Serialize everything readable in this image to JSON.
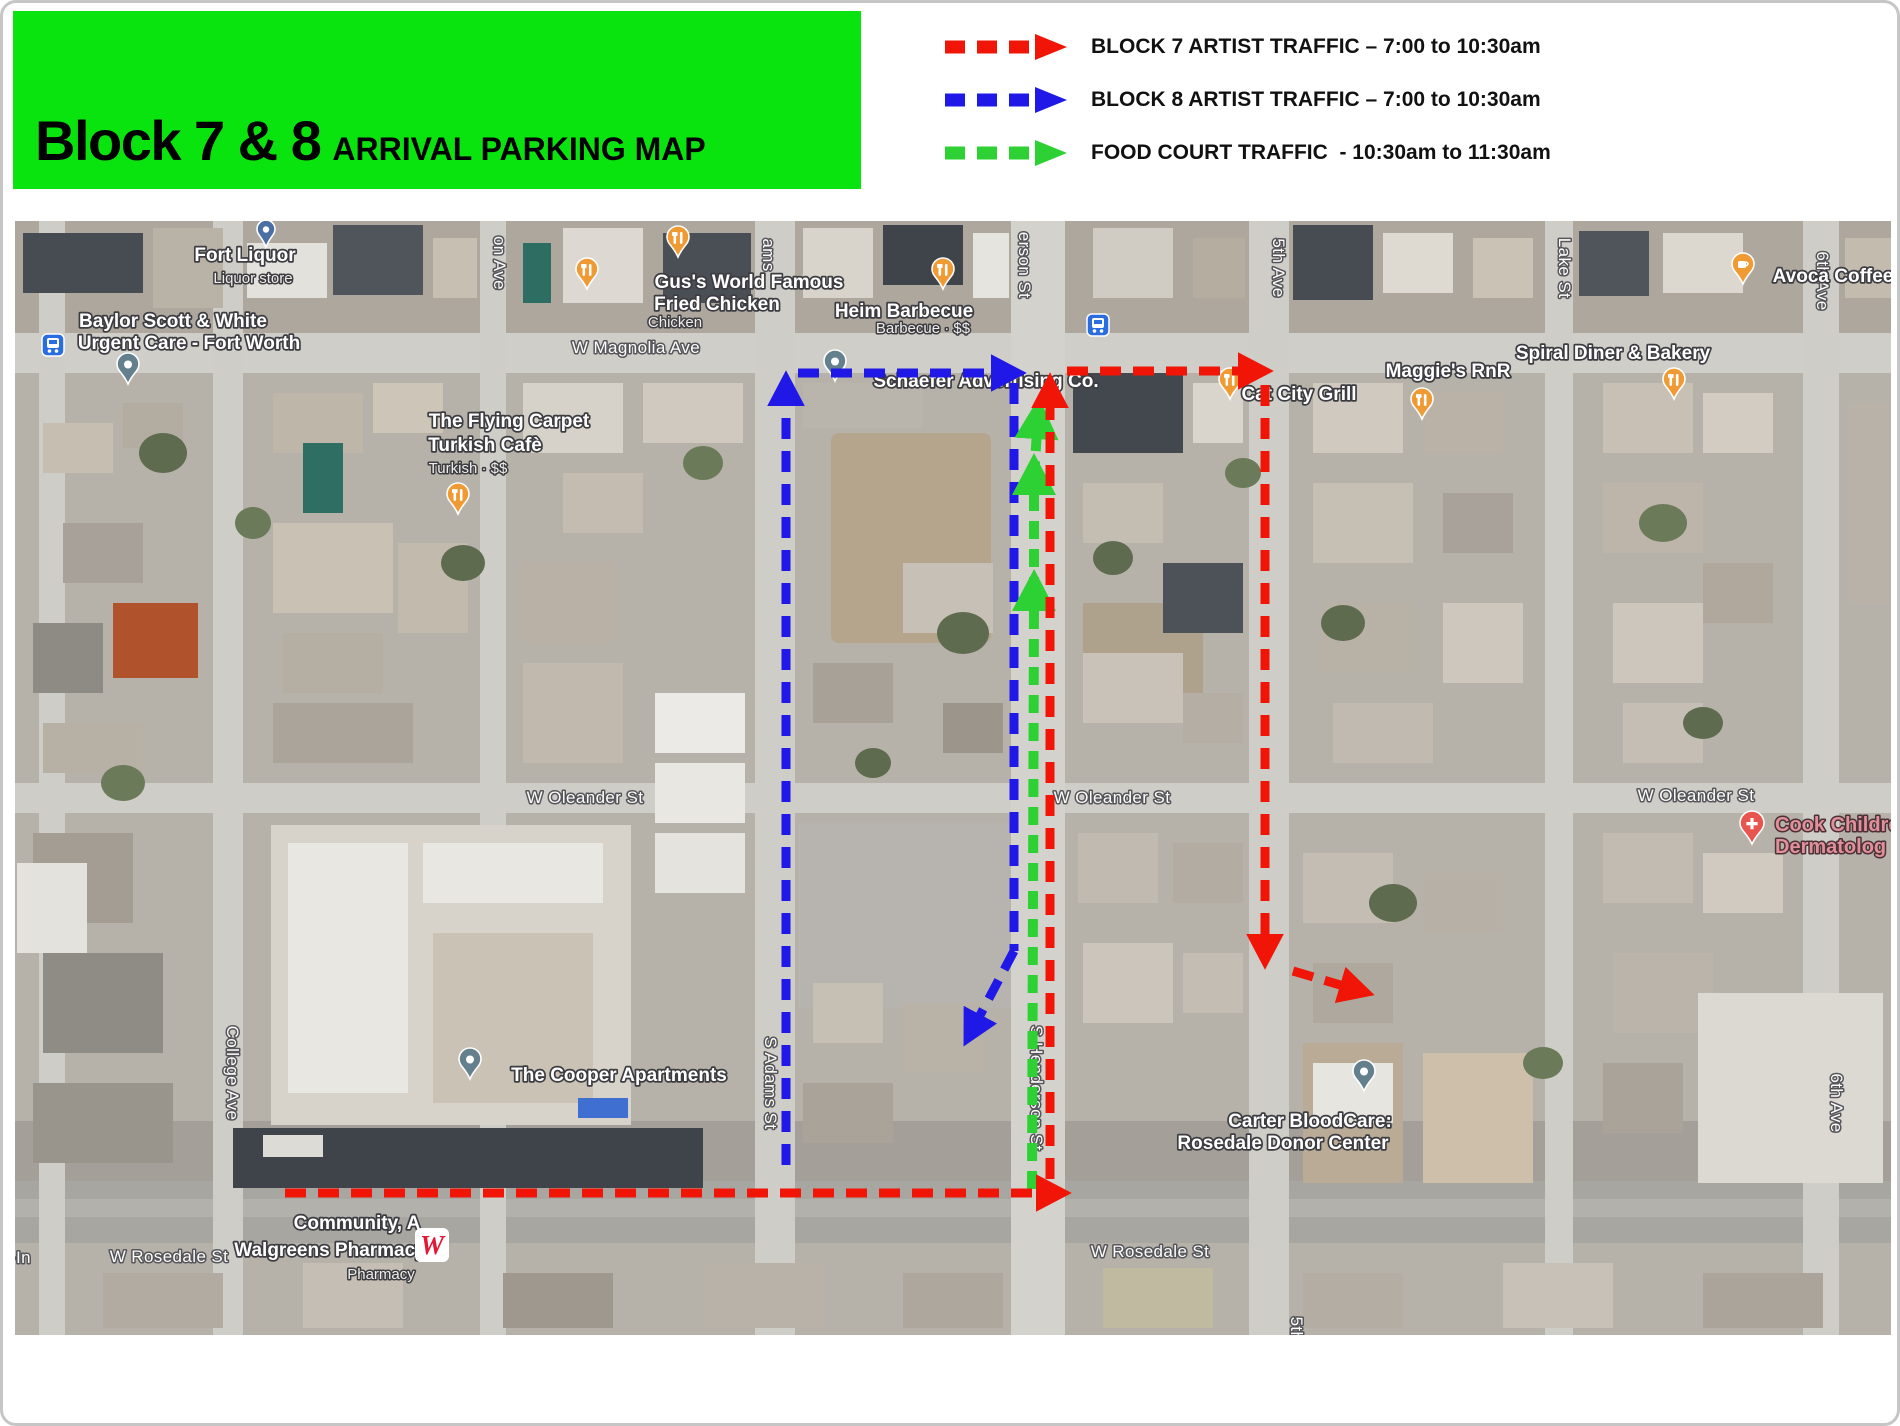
{
  "slide": {
    "title": "Block 7 & 8",
    "subtitle": "ARRIVAL PARKING MAP",
    "header_bg": "#09e40e"
  },
  "legend": {
    "items": [
      {
        "id": "block7",
        "color": "#f01507",
        "label": "BLOCK 7 ARTIST TRAFFIC – 7:00 to 10:30am"
      },
      {
        "id": "block8",
        "color": "#2018e6",
        "label": "BLOCK 8 ARTIST TRAFFIC – 7:00 to 10:30am"
      },
      {
        "id": "foodcourt",
        "color": "#2ed133",
        "label": "FOOD COURT TRAFFIC  - 10:30am to 11:30am"
      }
    ]
  },
  "map": {
    "colors": {
      "food_pin": "#f09a33",
      "coffee_pin": "#f09a33",
      "health_pin": "#e8554f",
      "place_pin": "#64808d",
      "store_pin": "#4a6fa5",
      "bus_icon": "#2a6de0",
      "walgreens_red": "#e31837"
    },
    "labels": [
      {
        "text": "W Magnolia Ave",
        "x": 633,
        "y": 350,
        "cls": "street"
      },
      {
        "text": "W Oleander St",
        "x": 582,
        "y": 800,
        "cls": "street"
      },
      {
        "text": "W Oleander St",
        "x": 1109,
        "y": 800,
        "cls": "street"
      },
      {
        "text": "W Oleander St",
        "x": 1693,
        "y": 798,
        "cls": "street"
      },
      {
        "text": "W Rosedale St",
        "x": 166,
        "y": 1259,
        "cls": "street"
      },
      {
        "text": "W Rosedale St",
        "x": 1147,
        "y": 1254,
        "cls": "street"
      },
      {
        "text": "-In",
        "x": 7,
        "y": 1260,
        "cls": "street",
        "anchor": "start"
      },
      {
        "text": "College Ave",
        "x": 224,
        "y": 1070,
        "cls": "street",
        "rot": 90
      },
      {
        "text": "on Ave",
        "x": 491,
        "y": 260,
        "cls": "street",
        "rot": 90
      },
      {
        "text": "ams",
        "x": 760,
        "y": 252,
        "cls": "street",
        "rot": 90
      },
      {
        "text": "S Adams St",
        "x": 762,
        "y": 1080,
        "cls": "street",
        "rot": 90
      },
      {
        "text": "erson St",
        "x": 1016,
        "y": 262,
        "cls": "street",
        "rot": 90
      },
      {
        "text": "S Henderson St",
        "x": 1028,
        "y": 1085,
        "cls": "street",
        "rot": 90
      },
      {
        "text": "5th Ave",
        "x": 1270,
        "y": 265,
        "cls": "street",
        "rot": 90
      },
      {
        "text": "Lake St",
        "x": 1556,
        "y": 265,
        "cls": "street",
        "rot": 90
      },
      {
        "text": "6th Ave",
        "x": 1814,
        "y": 278,
        "cls": "street",
        "rot": 90
      },
      {
        "text": "6th Ave",
        "x": 1828,
        "y": 1100,
        "cls": "street",
        "rot": 90
      },
      {
        "text": "5th",
        "x": 1288,
        "y": 1326,
        "cls": "street",
        "rot": 90
      },
      {
        "text": "Fort Liquor",
        "x": 242,
        "y": 258,
        "cls": "poi"
      },
      {
        "text": "Liquor store",
        "x": 250,
        "y": 280,
        "cls": "sub"
      },
      {
        "text": "Baylor Scott & White",
        "x": 170,
        "y": 324,
        "cls": "poi"
      },
      {
        "text": "Urgent Care - Fort Worth",
        "x": 186,
        "y": 346,
        "cls": "poi"
      },
      {
        "text": "Gus's World Famous",
        "x": 746,
        "y": 285,
        "cls": "poi"
      },
      {
        "text": "Fried Chicken",
        "x": 714,
        "y": 307,
        "cls": "poi"
      },
      {
        "text": "Chicken",
        "x": 672,
        "y": 324,
        "cls": "sub"
      },
      {
        "text": "Heim Barbecue",
        "x": 901,
        "y": 314,
        "cls": "poi"
      },
      {
        "text": "Barbecue · $$",
        "x": 920,
        "y": 330,
        "cls": "sub"
      },
      {
        "text": "The Flying Carpet",
        "x": 506,
        "y": 424,
        "cls": "poi"
      },
      {
        "text": "Turkish Cafè",
        "x": 482,
        "y": 448,
        "cls": "poi"
      },
      {
        "text": "Turkish · $$",
        "x": 465,
        "y": 470,
        "cls": "sub"
      },
      {
        "text": "Schaefer Advertising Co.",
        "x": 983,
        "y": 384,
        "cls": "poi"
      },
      {
        "text": "Cat City Grill",
        "x": 1296,
        "y": 397,
        "cls": "poi"
      },
      {
        "text": "Maggie's RnR",
        "x": 1445,
        "y": 374,
        "cls": "poi"
      },
      {
        "text": "Spiral Diner & Bakery",
        "x": 1610,
        "y": 356,
        "cls": "poi"
      },
      {
        "text": "Avoca Coffee",
        "x": 1830,
        "y": 279,
        "cls": "poi"
      },
      {
        "text": "Cook Childre",
        "x": 1772,
        "y": 828,
        "cls": "poi-pink",
        "anchor": "start"
      },
      {
        "text": "Dermatolog",
        "x": 1772,
        "y": 850,
        "cls": "poi-pink",
        "anchor": "start"
      },
      {
        "text": "The Cooper Apartments",
        "x": 616,
        "y": 1078,
        "cls": "poi"
      },
      {
        "text": "Carter BloodCare:",
        "x": 1307,
        "y": 1124,
        "cls": "poi"
      },
      {
        "text": "Rosedale Donor Center",
        "x": 1280,
        "y": 1146,
        "cls": "poi"
      },
      {
        "text": "Community, A",
        "x": 354,
        "y": 1226,
        "cls": "poi"
      },
      {
        "text": "Walgreens Pharmacy",
        "x": 327,
        "y": 1253,
        "cls": "poi"
      },
      {
        "text": "Pharmacy",
        "x": 378,
        "y": 1276,
        "cls": "sub"
      }
    ],
    "pins": [
      {
        "type": "food",
        "name": "restaurant-pin",
        "x": 584,
        "y": 268
      },
      {
        "type": "food",
        "name": "gus-fried-chicken-pin",
        "x": 675,
        "y": 236
      },
      {
        "type": "food",
        "name": "heim-barbecue-pin",
        "x": 940,
        "y": 268
      },
      {
        "type": "food",
        "name": "flying-carpet-pin",
        "x": 455,
        "y": 493
      },
      {
        "type": "food",
        "name": "cat-city-grill-pin",
        "x": 1227,
        "y": 378
      },
      {
        "type": "food",
        "name": "maggies-rnr-pin",
        "x": 1419,
        "y": 398
      },
      {
        "type": "food",
        "name": "spiral-diner-pin",
        "x": 1671,
        "y": 378
      },
      {
        "type": "coffee",
        "name": "avoca-coffee-pin",
        "x": 1740,
        "y": 263
      },
      {
        "type": "health",
        "name": "cook-childrens-pin",
        "x": 1749,
        "y": 822
      },
      {
        "type": "place",
        "name": "schaefer-advertising-pin",
        "x": 832,
        "y": 360
      },
      {
        "type": "place",
        "name": "cooper-apartments-pin",
        "x": 467,
        "y": 1058
      },
      {
        "type": "place",
        "name": "carter-bloodcare-pin",
        "x": 1361,
        "y": 1070
      },
      {
        "type": "place",
        "name": "baylor-urgent-care-pin",
        "x": 125,
        "y": 363
      },
      {
        "type": "store",
        "name": "fort-liquor-pin",
        "x": 263,
        "y": 228
      },
      {
        "type": "bus",
        "name": "bus-stop-icon",
        "x": 50,
        "y": 342
      },
      {
        "type": "bus",
        "name": "bus-stop-icon",
        "x": 1095,
        "y": 322
      },
      {
        "type": "walgreens",
        "name": "walgreens-logo",
        "letter": "W",
        "x": 429,
        "y": 1242
      }
    ]
  }
}
